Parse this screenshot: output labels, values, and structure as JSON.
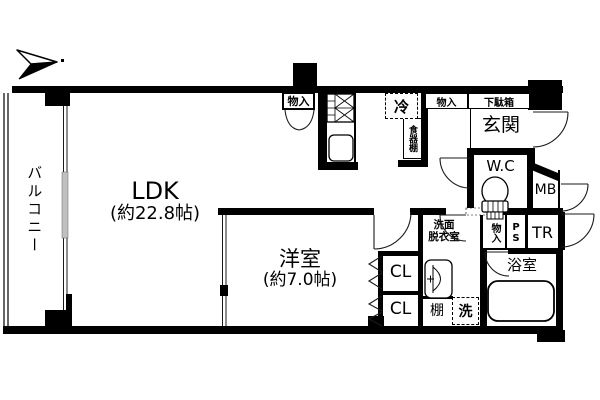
{
  "plan": {
    "balcony": {
      "label": "バルコニー"
    },
    "ldk": {
      "label": "LDK",
      "size": "(約22.8帖)"
    },
    "western_room": {
      "label": "洋室",
      "size": "(約7.0帖)"
    },
    "entrance": {
      "label": "玄関"
    },
    "shoe_cabinet": {
      "label": "下駄箱"
    },
    "wc": {
      "label": "W.C"
    },
    "meter_box": {
      "label": "MB"
    },
    "pipe_space": {
      "label": "PS"
    },
    "trunk_room": {
      "label": "TR"
    },
    "washroom": {
      "label_line1": "洗面",
      "label_line2": "脱衣室"
    },
    "bathroom": {
      "label": "浴室"
    },
    "closet_upper": {
      "label": "CL"
    },
    "closet_lower": {
      "label": "CL"
    },
    "shelf": {
      "label": "棚"
    },
    "washer": {
      "label": "洗"
    },
    "refrigerator": {
      "label": "冷"
    },
    "cupboard": {
      "label": "食器棚"
    },
    "storage_kitchen": {
      "label": "物入"
    },
    "storage_hall": {
      "label": "物入"
    },
    "storage_washroom": {
      "label": "物入"
    }
  },
  "colors": {
    "wall": "#000000",
    "background": "#ffffff",
    "line": "#1a1a1a"
  }
}
